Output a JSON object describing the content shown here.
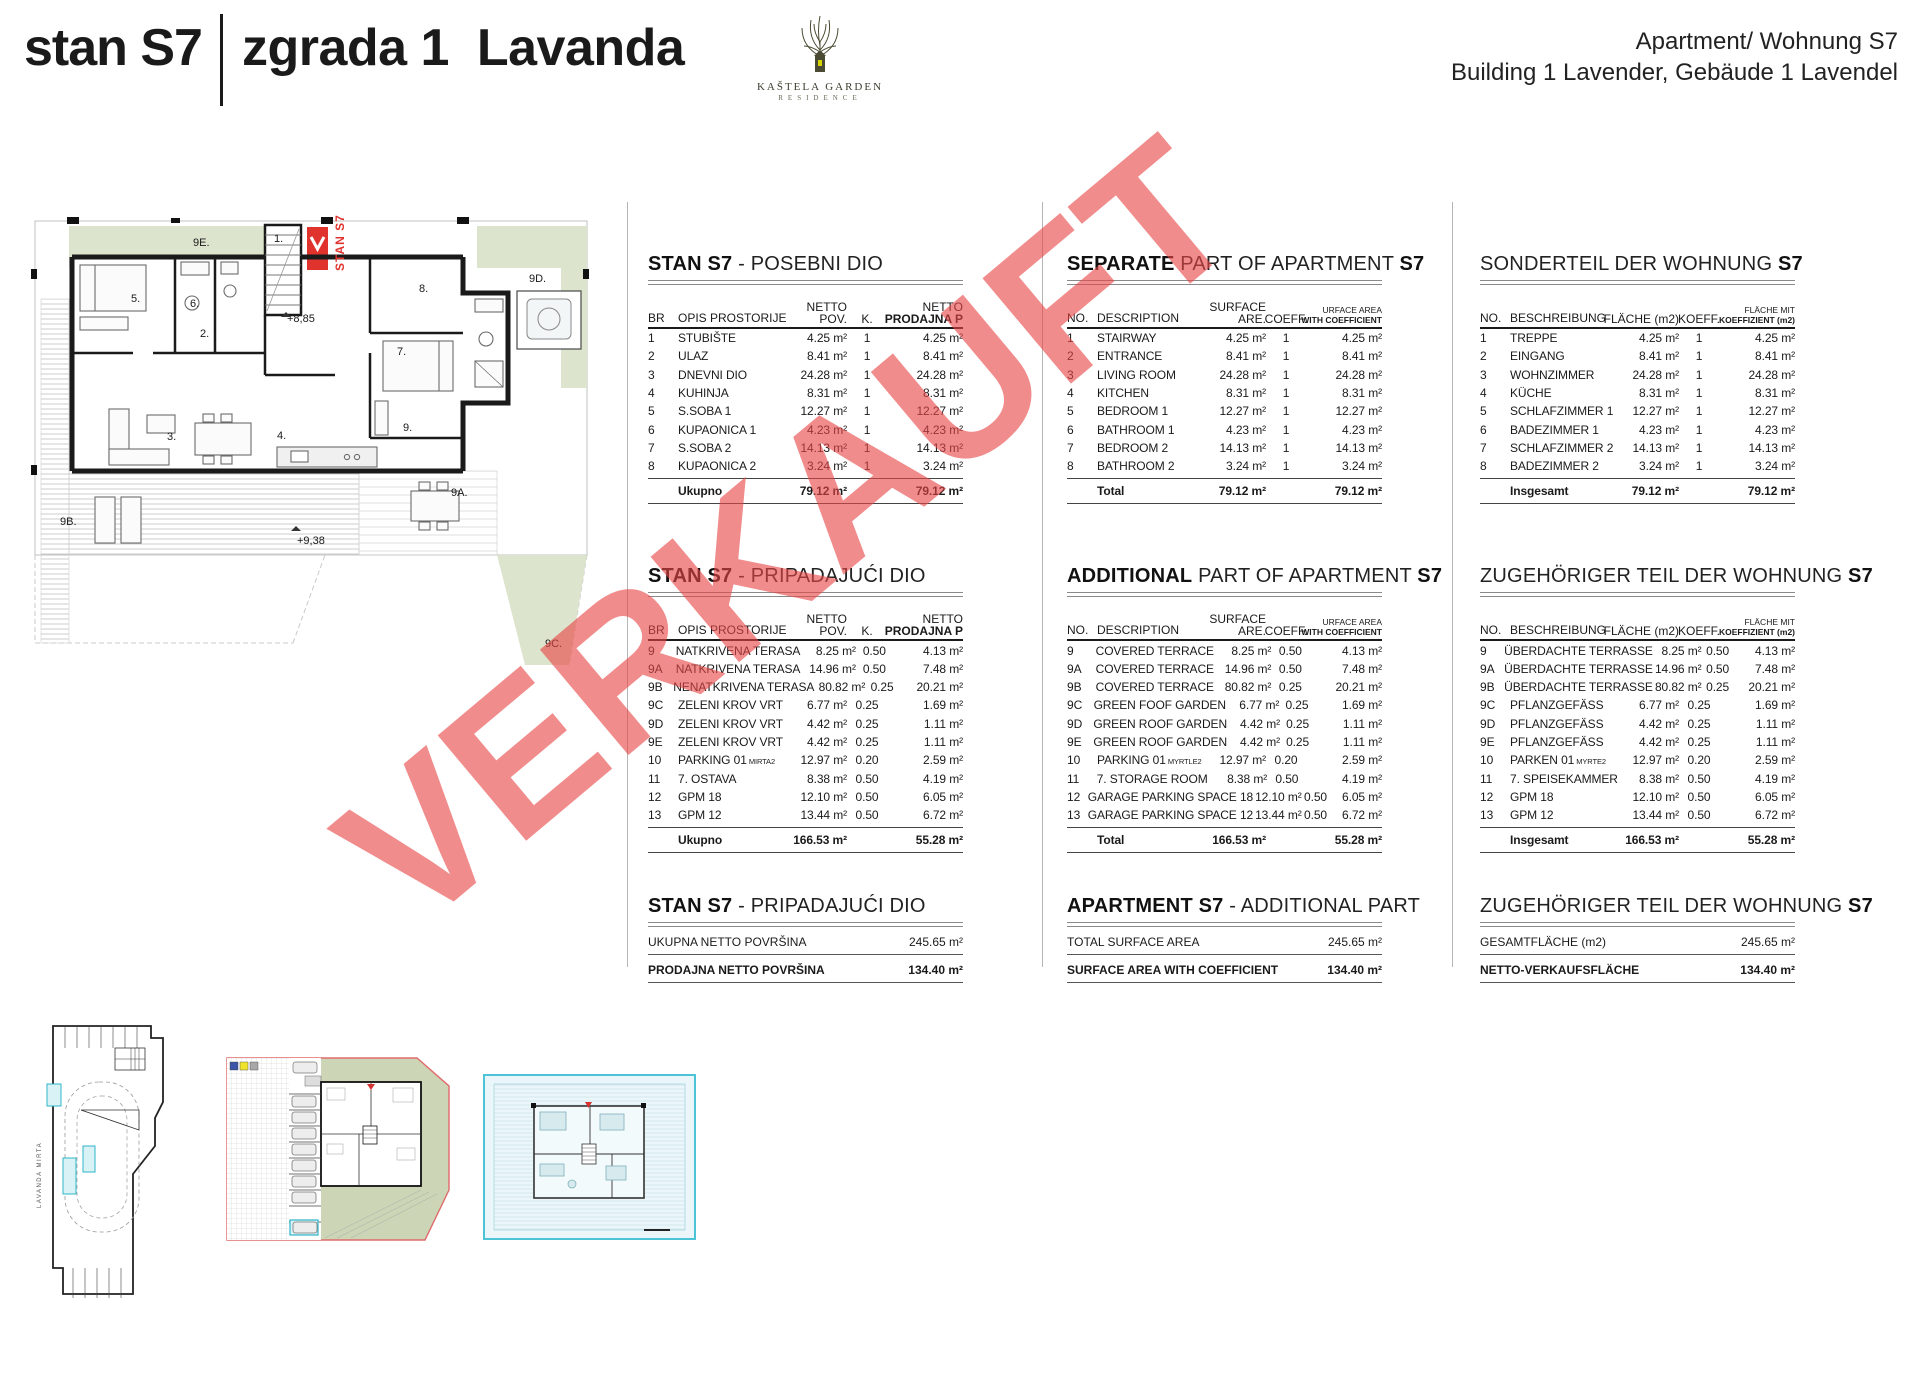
{
  "header": {
    "unit_label": "stan S7",
    "building_label": "zgrada 1  Lavanda",
    "right_line1": "Apartment/ Wohnung S7",
    "right_line2": "Building 1 Lavender, Gebäude 1 Lavendel",
    "logo_name": "KAŠTELA GARDEN",
    "logo_sub": "RESIDENCE"
  },
  "watermark": {
    "text": "VERKAUFT",
    "color": "#e94646"
  },
  "colors": {
    "marker_red": "#e0332d",
    "sage_green": "#dce4cd",
    "highlight_cyan": "#2fb4c9",
    "wall_black": "#1a1a1a",
    "watermark_red": "#e94646",
    "site_boundary_red": "#e06a6a",
    "legend_blue": "#3a55a5",
    "legend_yellow": "#efe32b",
    "legend_gray": "#a8a8a8"
  },
  "floorplan": {
    "labels": [
      {
        "t": "9E.",
        "x": 168,
        "y": 24
      },
      {
        "t": "9D.",
        "x": 504,
        "y": 60
      },
      {
        "t": "1.",
        "x": 249,
        "y": 20
      },
      {
        "t": "STAN S7",
        "x": 308,
        "y": 58,
        "cls": "vred"
      },
      {
        "t": "+8,85",
        "x": 262,
        "y": 100
      },
      {
        "t": "5.",
        "x": 106,
        "y": 80
      },
      {
        "t": "6.",
        "x": 165,
        "y": 85
      },
      {
        "t": "2.",
        "x": 175,
        "y": 115
      },
      {
        "t": "8.",
        "x": 394,
        "y": 70
      },
      {
        "t": "7.",
        "x": 372,
        "y": 133
      },
      {
        "t": "3.",
        "x": 142,
        "y": 218
      },
      {
        "t": "4.",
        "x": 252,
        "y": 217
      },
      {
        "t": "9.",
        "x": 378,
        "y": 209
      },
      {
        "t": "9A.",
        "x": 426,
        "y": 274
      },
      {
        "t": "9B.",
        "x": 35,
        "y": 303
      },
      {
        "t": "9C.",
        "x": 520,
        "y": 425
      },
      {
        "t": "+9,38",
        "x": 272,
        "y": 322
      }
    ]
  },
  "tables": {
    "hr": {
      "head": {
        "no": "BR",
        "desc": "OPIS PROSTORIJE",
        "surf_top": "NETTO",
        "surf_bot": "POV.",
        "coeff": "K.",
        "sale_top": "NETTO",
        "sale_bot": "PRODAJNA P"
      },
      "t1": {
        "title": [
          {
            "t": "STAN S7",
            "b": true
          },
          {
            "t": " - POSEBNI DIO"
          }
        ],
        "rows": [
          {
            "no": "1",
            "desc": "STUBIŠTE",
            "surface": "4.25 m²",
            "coeff": "1",
            "sale": "4.25 m²"
          },
          {
            "no": "2",
            "desc": "ULAZ",
            "surface": "8.41 m²",
            "coeff": "1",
            "sale": "8.41 m²"
          },
          {
            "no": "3",
            "desc": "DNEVNI DIO",
            "surface": "24.28 m²",
            "coeff": "1",
            "sale": "24.28 m²"
          },
          {
            "no": "4",
            "desc": "KUHINJA",
            "surface": "8.31 m²",
            "coeff": "1",
            "sale": "8.31 m²"
          },
          {
            "no": "5",
            "desc": "S.SOBA 1",
            "surface": "12.27 m²",
            "coeff": "1",
            "sale": "12.27 m²"
          },
          {
            "no": "6",
            "desc": "KUPAONICA 1",
            "surface": "4.23 m²",
            "coeff": "1",
            "sale": "4.23 m²"
          },
          {
            "no": "7",
            "desc": "S.SOBA 2",
            "surface": "14.13 m²",
            "coeff": "1",
            "sale": "14.13 m²"
          },
          {
            "no": "8",
            "desc": "KUPAONICA 2",
            "surface": "3.24 m²",
            "coeff": "1",
            "sale": "3.24 m²"
          }
        ],
        "total_label": "Ukupno",
        "total_surface": "79.12 m²",
        "total_sale": "79.12 m²"
      },
      "t2": {
        "title": [
          {
            "t": "STAN S7",
            "b": true
          },
          {
            "t": " - PRIPADAJUĆI DIO"
          }
        ],
        "rows": [
          {
            "no": "9",
            "desc": "NATKRIVENA TERASA",
            "surface": "8.25 m²",
            "coeff": "0.50",
            "sale": "4.13 m²"
          },
          {
            "no": "9A",
            "desc": "NATKRIVENA TERASA",
            "surface": "14.96 m²",
            "coeff": "0.50",
            "sale": "7.48 m²"
          },
          {
            "no": "9B",
            "desc": "NENATKRIVENA TERASA",
            "surface": "80.82 m²",
            "coeff": "0.25",
            "sale": "20.21 m²"
          },
          {
            "no": "9C",
            "desc": "ZELENI KROV VRT",
            "surface": "6.77 m²",
            "coeff": "0.25",
            "sale": "1.69 m²"
          },
          {
            "no": "9D",
            "desc": "ZELENI KROV VRT",
            "surface": "4.42 m²",
            "coeff": "0.25",
            "sale": "1.11 m²"
          },
          {
            "no": "9E",
            "desc": "ZELENI KROV VRT",
            "surface": "4.42 m²",
            "coeff": "0.25",
            "sale": "1.11 m²"
          },
          {
            "no": "10",
            "desc": "PARKING 01",
            "small": "MIRTA2",
            "surface": "12.97 m²",
            "coeff": "0.20",
            "sale": "2.59 m²"
          },
          {
            "no": "11",
            "desc": "7. OSTAVA",
            "surface": "8.38 m²",
            "coeff": "0.50",
            "sale": "4.19 m²"
          },
          {
            "no": "12",
            "desc": "GPM 18",
            "surface": "12.10 m²",
            "coeff": "0.50",
            "sale": "6.05 m²"
          },
          {
            "no": "13",
            "desc": "GPM 12",
            "surface": "13.44 m²",
            "coeff": "0.50",
            "sale": "6.72 m²"
          }
        ],
        "total_label": "Ukupno",
        "total_surface": "166.53 m²",
        "total_sale": "55.28 m²"
      },
      "summary": {
        "title": [
          {
            "t": "STAN S7",
            "b": true
          },
          {
            "t": " - PRIPADAJUĆI DIO"
          }
        ],
        "row1_label": "UKUPNA NETTO POVRŠINA",
        "row1_value": "245.65 m²",
        "row2_label": "PRODAJNA NETTO POVRŠINA",
        "row2_value": "134.40 m²"
      }
    },
    "en": {
      "head": {
        "no": "NO.",
        "desc": "DESCRIPTION",
        "surf_top": "SURFACE",
        "surf_bot": "ARE.",
        "coeff": "COEFF.",
        "sale_top": "URFACE AREA",
        "sale_bot": "WITH COEFFICIENT"
      },
      "t1": {
        "title": [
          {
            "t": "SEPARATE",
            "b": true
          },
          {
            "t": " PART OF APARTMENT "
          },
          {
            "t": "S7",
            "b": true
          }
        ],
        "rows": [
          {
            "no": "1",
            "desc": "STAIRWAY",
            "surface": "4.25 m²",
            "coeff": "1",
            "sale": "4.25 m²"
          },
          {
            "no": "2",
            "desc": "ENTRANCE",
            "surface": "8.41 m²",
            "coeff": "1",
            "sale": "8.41 m²"
          },
          {
            "no": "3",
            "desc": "LIVING ROOM",
            "surface": "24.28 m²",
            "coeff": "1",
            "sale": "24.28 m²"
          },
          {
            "no": "4",
            "desc": "KITCHEN",
            "surface": "8.31 m²",
            "coeff": "1",
            "sale": "8.31 m²"
          },
          {
            "no": "5",
            "desc": "BEDROOM 1",
            "surface": "12.27 m²",
            "coeff": "1",
            "sale": "12.27 m²"
          },
          {
            "no": "6",
            "desc": "BATHROOM 1",
            "surface": "4.23 m²",
            "coeff": "1",
            "sale": "4.23 m²"
          },
          {
            "no": "7",
            "desc": "BEDROOM 2",
            "surface": "14.13 m²",
            "coeff": "1",
            "sale": "14.13 m²"
          },
          {
            "no": "8",
            "desc": "BATHROOM 2",
            "surface": "3.24 m²",
            "coeff": "1",
            "sale": "3.24 m²"
          }
        ],
        "total_label": "Total",
        "total_surface": "79.12 m²",
        "total_sale": "79.12 m²"
      },
      "t2": {
        "title": [
          {
            "t": "ADDITIONAL",
            "b": true
          },
          {
            "t": " PART OF APARTMENT "
          },
          {
            "t": "S7",
            "b": true
          }
        ],
        "rows": [
          {
            "no": "9",
            "desc": "COVERED TERRACE",
            "surface": "8.25 m²",
            "coeff": "0.50",
            "sale": "4.13 m²"
          },
          {
            "no": "9A",
            "desc": "COVERED TERRACE",
            "surface": "14.96 m²",
            "coeff": "0.50",
            "sale": "7.48 m²"
          },
          {
            "no": "9B",
            "desc": "COVERED TERRACE",
            "surface": "80.82 m²",
            "coeff": "0.25",
            "sale": "20.21 m²"
          },
          {
            "no": "9C",
            "desc": "GREEN FOOF GARDEN",
            "surface": "6.77 m²",
            "coeff": "0.25",
            "sale": "1.69 m²"
          },
          {
            "no": "9D",
            "desc": "GREEN ROOF GARDEN",
            "surface": "4.42 m²",
            "coeff": "0.25",
            "sale": "1.11 m²"
          },
          {
            "no": "9E",
            "desc": "GREEN ROOF GARDEN",
            "surface": "4.42 m²",
            "coeff": "0.25",
            "sale": "1.11 m²"
          },
          {
            "no": "10",
            "desc": "PARKING 01",
            "small": "MYRTLE2",
            "surface": "12.97 m²",
            "coeff": "0.20",
            "sale": "2.59 m²"
          },
          {
            "no": "11",
            "desc": "7. STORAGE ROOM",
            "surface": "8.38 m²",
            "coeff": "0.50",
            "sale": "4.19 m²"
          },
          {
            "no": "12",
            "desc": "GARAGE PARKING SPACE 18",
            "surface": "12.10 m²",
            "coeff": "0.50",
            "sale": "6.05 m²"
          },
          {
            "no": "13",
            "desc": "GARAGE PARKING SPACE 12",
            "surface": "13.44 m²",
            "coeff": "0.50",
            "sale": "6.72 m²"
          }
        ],
        "total_label": "Total",
        "total_surface": "166.53 m²",
        "total_sale": "55.28 m²"
      },
      "summary": {
        "title": [
          {
            "t": "APARTMENT S7",
            "b": true
          },
          {
            "t": " - ADDITIONAL PART"
          }
        ],
        "row1_label": "TOTAL SURFACE AREA",
        "row1_value": "245.65 m²",
        "row2_label": "SURFACE AREA WITH COEFFICIENT",
        "row2_value": "134.40 m²"
      }
    },
    "de": {
      "head": {
        "no": "NO.",
        "desc": "BESCHREIBUNG",
        "surf_top": "",
        "surf_bot": "FLÄCHE (m2)",
        "coeff": "KOEFF.",
        "sale_top": "FLÄCHE MIT",
        "sale_bot": "KOEFFIZIENT (m2)"
      },
      "t1": {
        "title": [
          {
            "t": "SONDERTEIL DER WOHNUNG "
          },
          {
            "t": "S7",
            "b": true
          }
        ],
        "rows": [
          {
            "no": "1",
            "desc": "TREPPE",
            "surface": "4.25 m²",
            "coeff": "1",
            "sale": "4.25 m²"
          },
          {
            "no": "2",
            "desc": "EINGANG",
            "surface": "8.41 m²",
            "coeff": "1",
            "sale": "8.41 m²"
          },
          {
            "no": "3",
            "desc": "WOHNZIMMER",
            "surface": "24.28 m²",
            "coeff": "1",
            "sale": "24.28 m²"
          },
          {
            "no": "4",
            "desc": "KÜCHE",
            "surface": "8.31 m²",
            "coeff": "1",
            "sale": "8.31 m²"
          },
          {
            "no": "5",
            "desc": "SCHLAFZIMMER 1",
            "surface": "12.27 m²",
            "coeff": "1",
            "sale": "12.27 m²"
          },
          {
            "no": "6",
            "desc": "BADEZIMMER 1",
            "surface": "4.23 m²",
            "coeff": "1",
            "sale": "4.23 m²"
          },
          {
            "no": "7",
            "desc": "SCHLAFZIMMER 2",
            "surface": "14.13 m²",
            "coeff": "1",
            "sale": "14.13 m²"
          },
          {
            "no": "8",
            "desc": "BADEZIMMER 2",
            "surface": "3.24 m²",
            "coeff": "1",
            "sale": "3.24 m²"
          }
        ],
        "total_label": "Insgesamt",
        "total_surface": "79.12 m²",
        "total_sale": "79.12 m²"
      },
      "t2": {
        "title": [
          {
            "t": "ZUGEHÖRIGER TEIL DER WOHNUNG "
          },
          {
            "t": "S7",
            "b": true
          }
        ],
        "rows": [
          {
            "no": "9",
            "desc": "ÜBERDACHTE TERRASSE",
            "surface": "8.25 m²",
            "coeff": "0.50",
            "sale": "4.13 m²"
          },
          {
            "no": "9A",
            "desc": "ÜBERDACHTE TERRASSE",
            "surface": "14.96 m²",
            "coeff": "0.50",
            "sale": "7.48 m²"
          },
          {
            "no": "9B",
            "desc": "ÜBERDACHTE TERRASSE",
            "surface": "80.82 m²",
            "coeff": "0.25",
            "sale": "20.21 m²"
          },
          {
            "no": "9C",
            "desc": "PFLANZGEFÄSS",
            "surface": "6.77 m²",
            "coeff": "0.25",
            "sale": "1.69 m²"
          },
          {
            "no": "9D",
            "desc": "PFLANZGEFÄSS",
            "surface": "4.42 m²",
            "coeff": "0.25",
            "sale": "1.11 m²"
          },
          {
            "no": "9E",
            "desc": "PFLANZGEFÄSS",
            "surface": "4.42 m²",
            "coeff": "0.25",
            "sale": "1.11 m²"
          },
          {
            "no": "10",
            "desc": "PARKEN 01",
            "small": "MYRTE2",
            "surface": "12.97 m²",
            "coeff": "0.20",
            "sale": "2.59 m²"
          },
          {
            "no": "11",
            "desc": "7. SPEISEKAMMER",
            "surface": "8.38 m²",
            "coeff": "0.50",
            "sale": "4.19 m²"
          },
          {
            "no": "12",
            "desc": "GPM 18",
            "surface": "12.10 m²",
            "coeff": "0.50",
            "sale": "6.05 m²"
          },
          {
            "no": "13",
            "desc": "GPM 12",
            "surface": "13.44 m²",
            "coeff": "0.50",
            "sale": "6.72 m²"
          }
        ],
        "total_label": "Insgesamt",
        "total_surface": "166.53 m²",
        "total_sale": "55.28 m²"
      },
      "summary": {
        "title": [
          {
            "t": "ZUGEHÖRIGER TEIL DER WOHNUNG "
          },
          {
            "t": "S7",
            "b": true
          }
        ],
        "row1_label": "GESAMTFLÄCHE (m2)",
        "row1_value": "245.65 m²",
        "row2_label": "NETTO-VERKAUFSFLÄCHE",
        "row2_value": "134.40 m²"
      }
    }
  },
  "minis": {
    "garage": {
      "side_label": "LAVANDA   MIRTA"
    }
  }
}
